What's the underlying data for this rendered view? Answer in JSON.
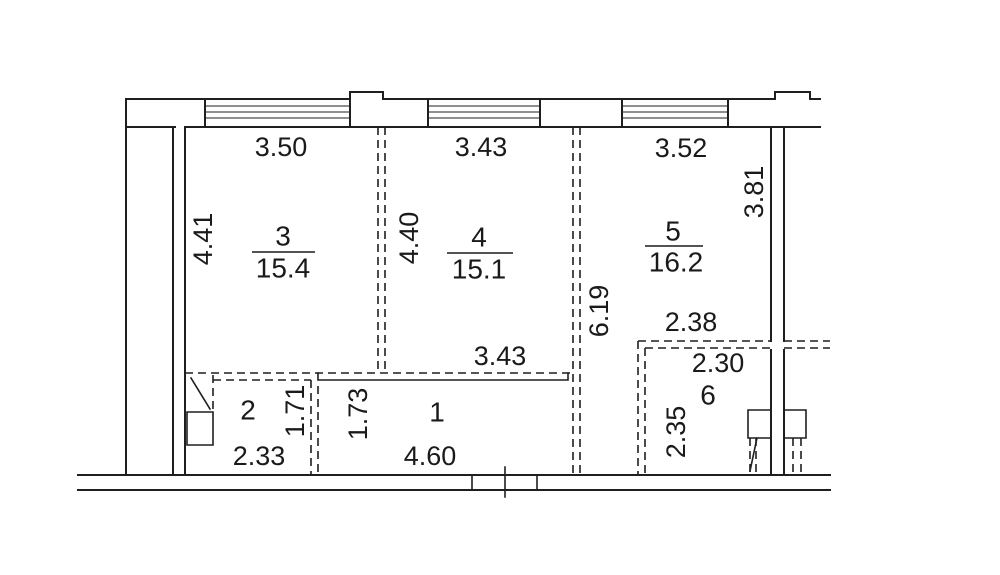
{
  "colors": {
    "line": "#1f1f1f",
    "text": "#1a1a1a",
    "background": "#ffffff"
  },
  "rooms": {
    "r1": {
      "number": "1",
      "width": "4.60",
      "height": "1.73"
    },
    "r2": {
      "number": "2",
      "width": "2.33",
      "height": "1.71"
    },
    "r3": {
      "number": "3",
      "area": "15.4",
      "width": "3.50",
      "height": "4.41"
    },
    "r4": {
      "number": "4",
      "area": "15.1",
      "width": "3.43",
      "height": "4.40",
      "width_bottom": "3.43"
    },
    "r5": {
      "number": "5",
      "area": "16.2",
      "width": "3.52",
      "height": "3.81"
    },
    "r6": {
      "number": "6",
      "width_above": "2.38",
      "width": "2.30",
      "height": "2.35"
    },
    "corridor": {
      "height": "6.19"
    }
  }
}
